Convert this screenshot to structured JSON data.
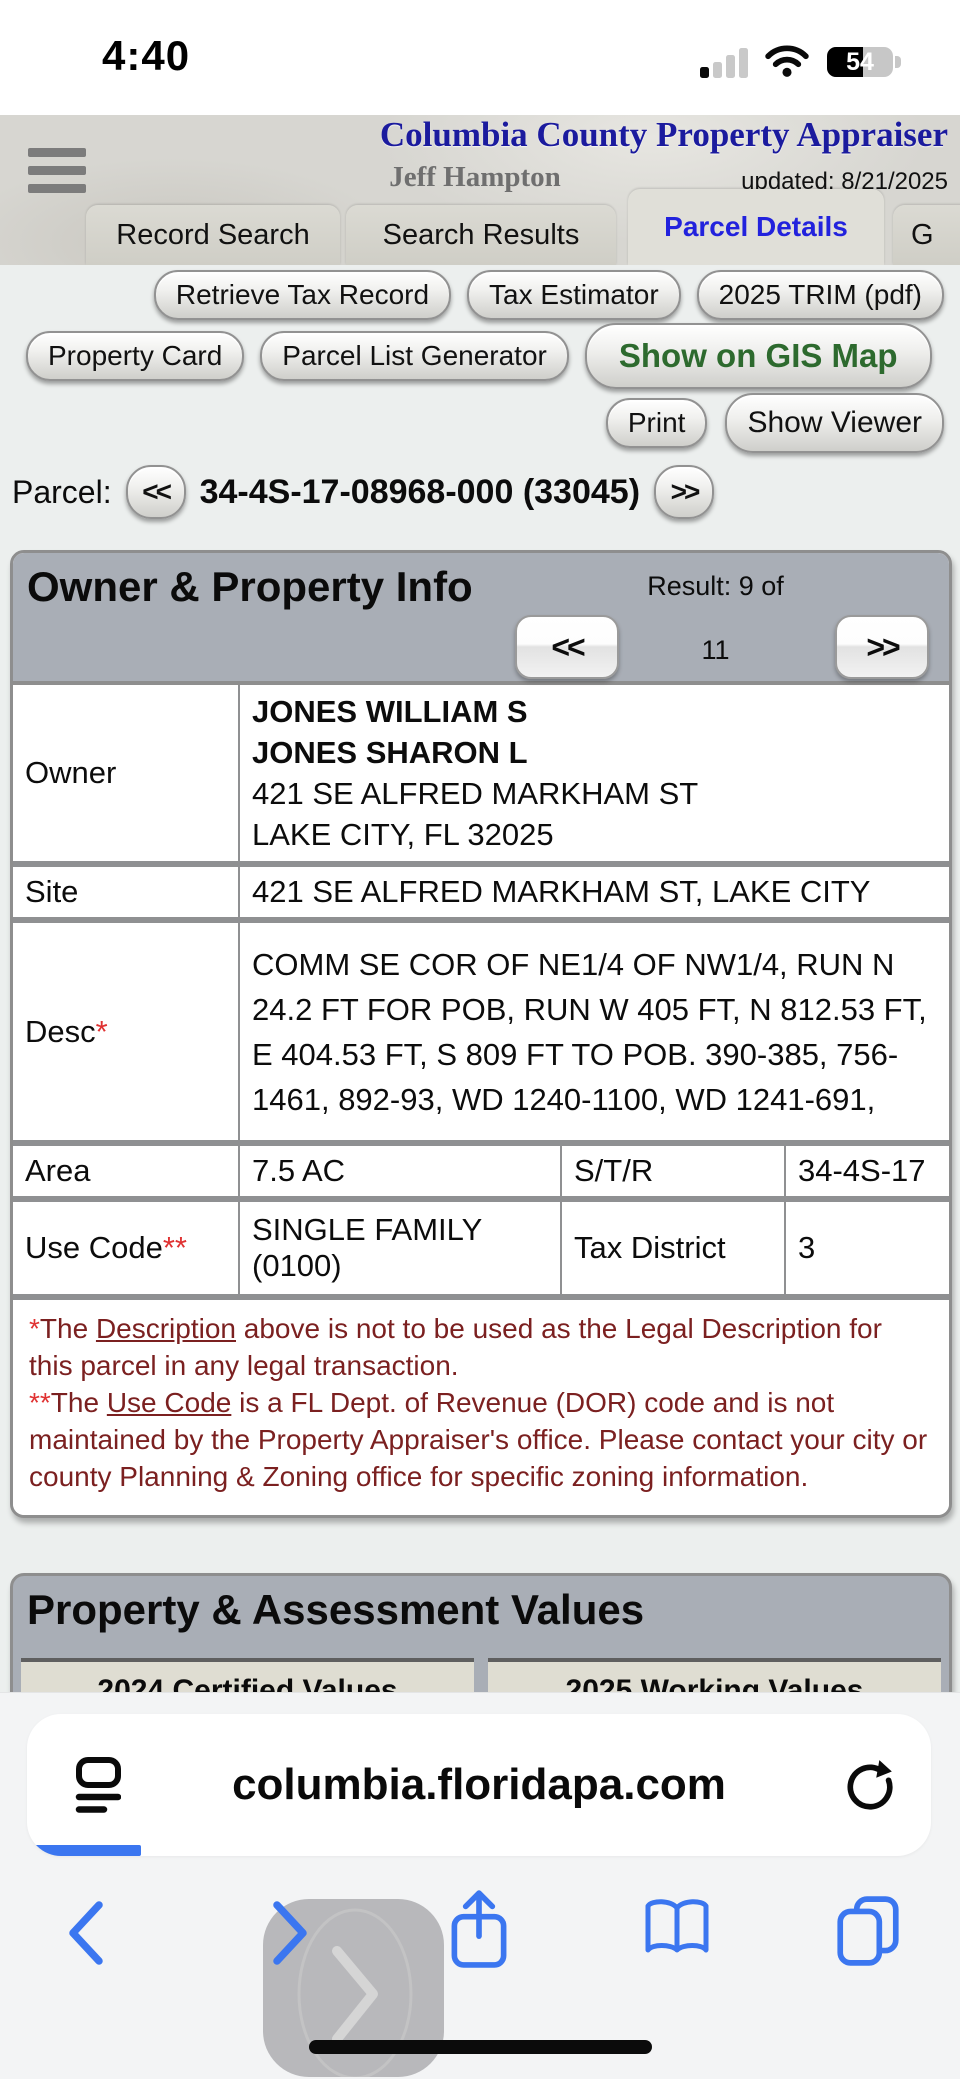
{
  "status": {
    "time": "4:40",
    "battery_percent": "54"
  },
  "header": {
    "title": "Columbia County Property Appraiser",
    "subtitle": "Jeff Hampton",
    "updated": "updated: 8/21/2025"
  },
  "tabs": {
    "record": "Record Search",
    "results": "Search Results",
    "details": "Parcel Details",
    "gis_partial": "G"
  },
  "toolbar": {
    "retrieve": "Retrieve Tax Record",
    "estimator": "Tax Estimator",
    "trim": "2025 TRIM (pdf)",
    "property_card": "Property Card",
    "parcel_list": "Parcel List Generator",
    "gis_map": "Show on GIS Map",
    "print": "Print",
    "viewer": "Show Viewer"
  },
  "parcel": {
    "label": "Parcel:",
    "prev": "<<",
    "number": "34-4S-17-08968-000 (33045)",
    "next": ">>"
  },
  "owner_panel": {
    "title": "Owner & Property Info",
    "result_line": "Result: 9 of",
    "result_total": "11",
    "prev": "<<",
    "next": ">>",
    "rows": {
      "owner_label": "Owner",
      "owner_name1": "JONES WILLIAM S",
      "owner_name2": "JONES SHARON L",
      "owner_addr1": "421 SE ALFRED MARKHAM ST",
      "owner_addr2": "LAKE CITY, FL 32025",
      "site_label": "Site",
      "site_value": "421 SE ALFRED MARKHAM ST, LAKE CITY",
      "desc_label": "Desc",
      "desc_star": "*",
      "desc_value": "COMM SE COR OF NE1/4 OF NW1/4, RUN N 24.2 FT FOR POB, RUN W 405 FT, N 812.53 FT, E 404.53 FT, S 809 FT TO POB. 390-385, 756-1461, 892-93, WD 1240-1100, WD 1241-691,",
      "area_label": "Area",
      "area_value": "7.5 AC",
      "str_label": "S/T/R",
      "str_value": "34-4S-17",
      "use_label": "Use Code",
      "use_stars": "**",
      "use_value": "SINGLE FAMILY (0100)",
      "tax_label": "Tax District",
      "tax_value": "3"
    },
    "footnotes": {
      "f1_star": "*",
      "f1_pre": "The ",
      "f1_link": "Description",
      "f1_post": " above is not to be used as the Legal Description for this parcel in any legal transaction.",
      "f2_star": "**",
      "f2_pre": "The ",
      "f2_link": "Use Code",
      "f2_post": " is a FL Dept. of Revenue (DOR) code and is not maintained by the Property Appraiser's office. Please contact your city or county Planning & Zoning office for specific zoning information."
    }
  },
  "values_panel": {
    "title": "Property & Assessment Values",
    "col_2024": "2024 Certified Values",
    "col_2025": "2025 Working Values"
  },
  "browser": {
    "url": "columbia.floridapa.com"
  },
  "colors": {
    "accent_blue": "#3B76F0",
    "title_navy": "#1B1B9E",
    "active_tab_blue": "#2222DD",
    "gis_green": "#2D6A2E",
    "footnote_red": "#7B2020",
    "bright_red": "#E03232",
    "panel_header_gray": "#A9AEB6",
    "label_cell_beige": "#DFDDD2"
  }
}
